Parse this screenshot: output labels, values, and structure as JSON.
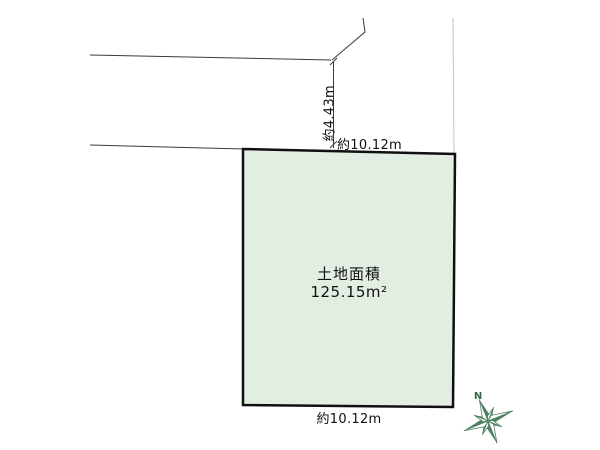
{
  "plan": {
    "land": {
      "area_title": "土地面積",
      "area_value": "125.15m²",
      "fill_color": "#e3eee2",
      "border_color": "#101010"
    },
    "dimensions": {
      "top_width": "約10.12m",
      "side_depth": "約4.43m",
      "bottom_width": "約10.12m"
    },
    "compass": {
      "north_label": "N",
      "color": "#4e8162",
      "label_color": "#2f6a49"
    },
    "lines": {
      "road_color": "#3a3a3a",
      "boundary_faint_color": "#c6c6c6"
    }
  }
}
